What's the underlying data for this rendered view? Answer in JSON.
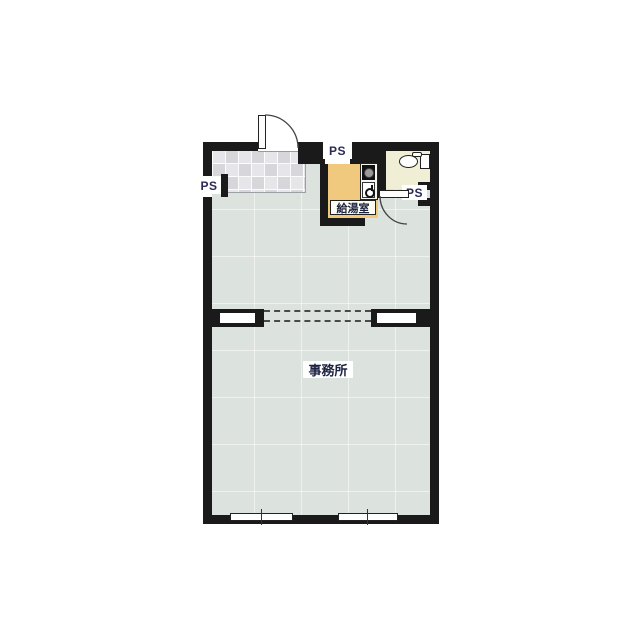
{
  "plan": {
    "type": "japanese-floorplan",
    "labels": {
      "office": "事務所",
      "kitchenette": "給湯室",
      "ps_top": "PS",
      "ps_left": "PS",
      "ps_right": "PS"
    },
    "rooms": [
      {
        "id": "office",
        "label": "事務所",
        "floor": "#dce2dd",
        "features": [
          "two sliding windows on bottom wall",
          "dashed removable partition across middle"
        ]
      },
      {
        "id": "entrance",
        "label": "",
        "floor": "checkered gray tile",
        "features": [
          "outward-swinging entrance door at top wall"
        ]
      },
      {
        "id": "kitchenette",
        "label": "給湯室",
        "floor": "#f0c87e",
        "features": [
          "stove and sink counter on right side",
          "open doorway at bottom right"
        ]
      },
      {
        "id": "toilet",
        "label": "",
        "floor": "#f1eed6",
        "features": [
          "toilet with tank against right wall",
          "door swinging down into office"
        ]
      }
    ],
    "pipe_spaces": [
      {
        "id": "ps_top",
        "position": "top wall above kitchenette"
      },
      {
        "id": "ps_left",
        "position": "left wall below entrance tiles"
      },
      {
        "id": "ps_right",
        "position": "right wall below toilet room"
      }
    ],
    "colors": {
      "wall": "#1a1a1a",
      "floor_main": "#dce2dd",
      "floor_tile_a": "#d6d6db",
      "floor_tile_b": "#e6e6ea",
      "floor_kitchenette": "#f0c87e",
      "floor_toilet": "#f1eed6",
      "label_text": "#1b2240",
      "ps_text": "#2a2a55",
      "background": "#ffffff"
    }
  }
}
